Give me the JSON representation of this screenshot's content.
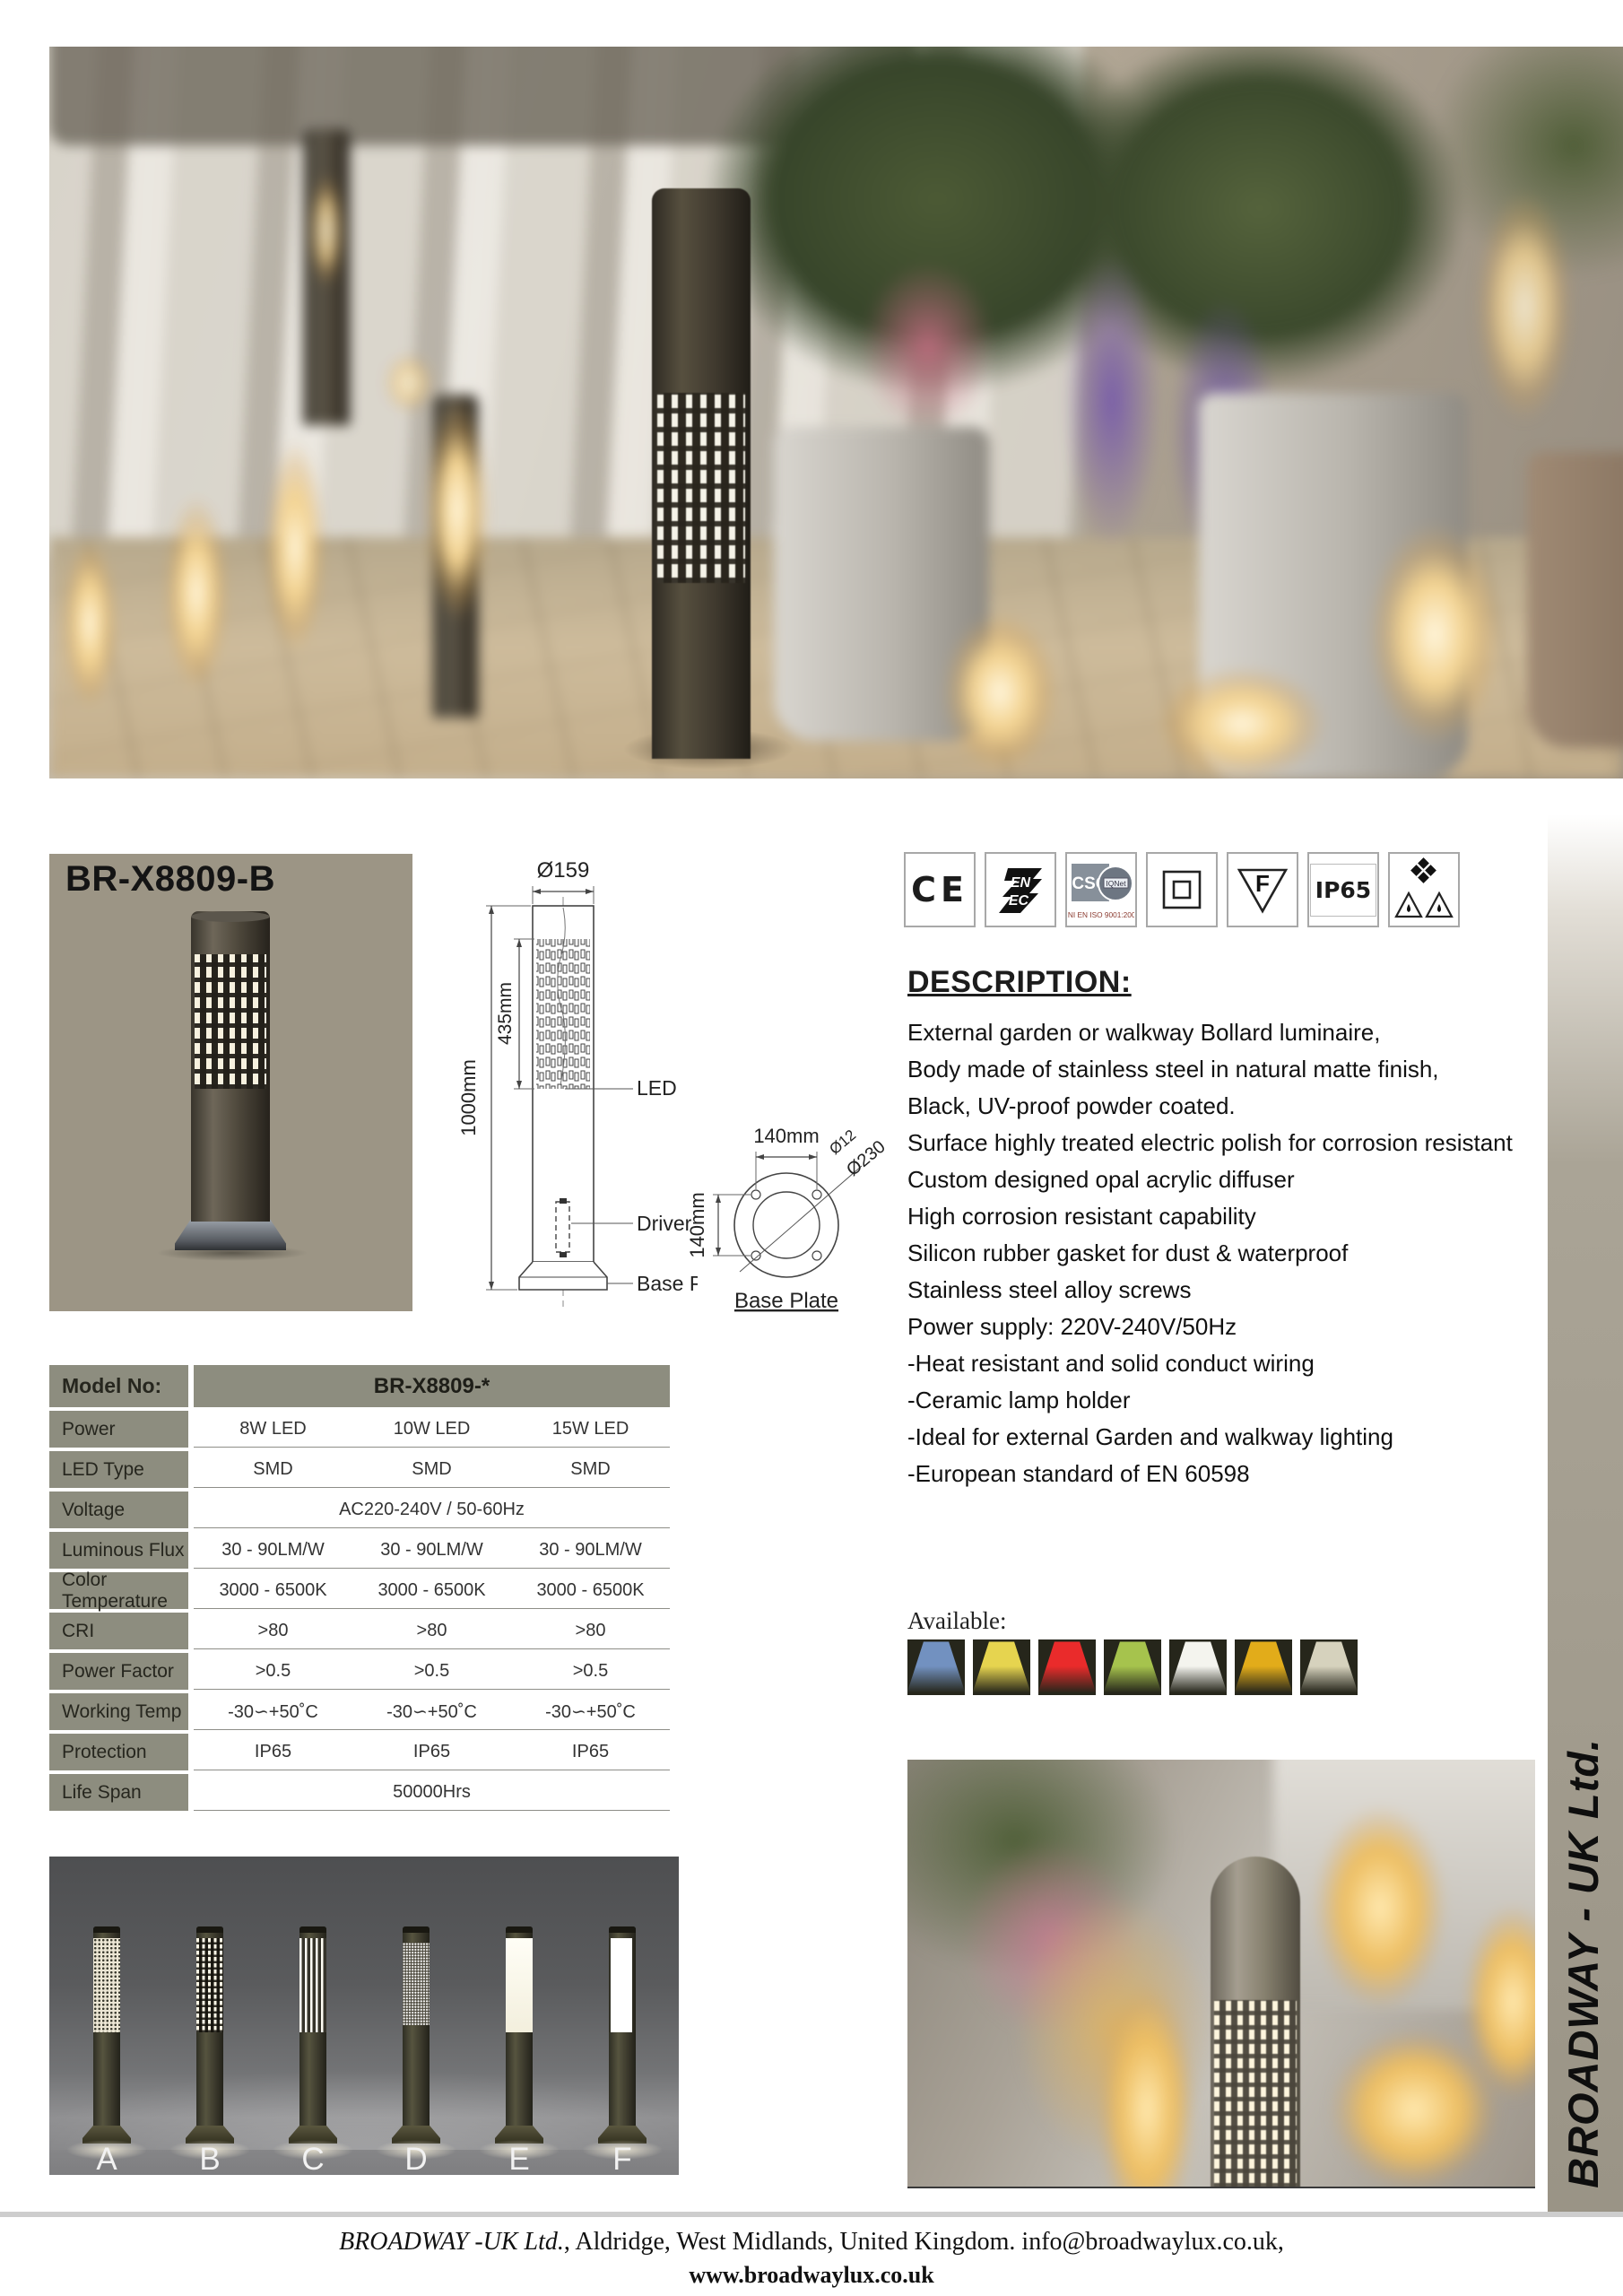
{
  "card": {
    "model": "BR-X8809-B"
  },
  "drawing": {
    "dia_label": "Ø159",
    "overall_height": "1000mm",
    "band_height": "435mm",
    "led_label": "LED",
    "driver_label": "Driver",
    "baseplate_label": "Base Plate",
    "bp_width": "140mm",
    "bp_height": "140mm",
    "bp_hole_dia": "Ø12",
    "bp_outer_dia": "Ø230",
    "bp_caption": "Base Plate"
  },
  "certs": {
    "ce": "CE",
    "enec_top": "EN",
    "enec_bottom": "EC",
    "csq": "CSQ",
    "iqnet": "IQNet",
    "csq_caption": "UNI EN ISO 9001:2000",
    "f_mark": "F",
    "ip65": "IP65"
  },
  "description": {
    "heading": "DESCRIPTION:",
    "lines": [
      "External garden or walkway Bollard luminaire,",
      "Body made of stainless steel in natural matte finish,",
      "Black, UV-proof powder coated.",
      "Surface highly treated electric polish for corrosion resistant",
      "Custom designed opal acrylic diffuser",
      "High corrosion resistant capability",
      "Silicon rubber gasket for dust & waterproof",
      "Stainless steel alloy screws",
      "Power supply: 220V-240V/50Hz",
      "-Heat resistant and solid conduct wiring",
      "-Ceramic lamp holder",
      "-Ideal for external Garden and walkway lighting",
      "-European standard of EN 60598"
    ]
  },
  "table": {
    "rows": [
      {
        "label": "Model No:",
        "span": "BR-X8809-*",
        "header": true
      },
      {
        "label": "Power",
        "cells": [
          "8W LED",
          "10W LED",
          "15W LED"
        ]
      },
      {
        "label": "LED Type",
        "cells": [
          "SMD",
          "SMD",
          "SMD"
        ]
      },
      {
        "label": "Voltage",
        "span": "AC220-240V / 50-60Hz"
      },
      {
        "label": "Luminous Flux",
        "cells": [
          "30 - 90LM/W",
          "30 - 90LM/W",
          "30 - 90LM/W"
        ]
      },
      {
        "label": "Color Temperature",
        "cells": [
          "3000 - 6500K",
          "3000 - 6500K",
          "3000 - 6500K"
        ]
      },
      {
        "label": "CRI",
        "cells": [
          ">80",
          ">80",
          ">80"
        ]
      },
      {
        "label": "Power Factor",
        "cells": [
          ">0.5",
          ">0.5",
          ">0.5"
        ]
      },
      {
        "label": "Working Temp",
        "cells": [
          "-30∽+50˚C",
          "-30∽+50˚C",
          "-30∽+50˚C"
        ]
      },
      {
        "label": "Protection",
        "cells": [
          "IP65",
          "IP65",
          "IP65"
        ]
      },
      {
        "label": "Life Span",
        "span": "50000Hrs"
      }
    ]
  },
  "available": {
    "label": "Available:",
    "colors": [
      "#7291c0",
      "#e6d44f",
      "#ea2b2b",
      "#a6c34d",
      "#f4f4ee",
      "#e2ac1a",
      "#d6d2bd"
    ]
  },
  "variants": {
    "letters": [
      "A",
      "B",
      "C",
      "D",
      "E",
      "F"
    ]
  },
  "sidebar": {
    "text": "BROADWAY - UK Ltd."
  },
  "footer": {
    "company_italic": "BROADWAY -UK Ltd.",
    "address_rest": ", Aldridge, West Midlands, United Kingdom. info@broadwaylux.co.uk,",
    "website": "www.broadwaylux.co.uk"
  }
}
